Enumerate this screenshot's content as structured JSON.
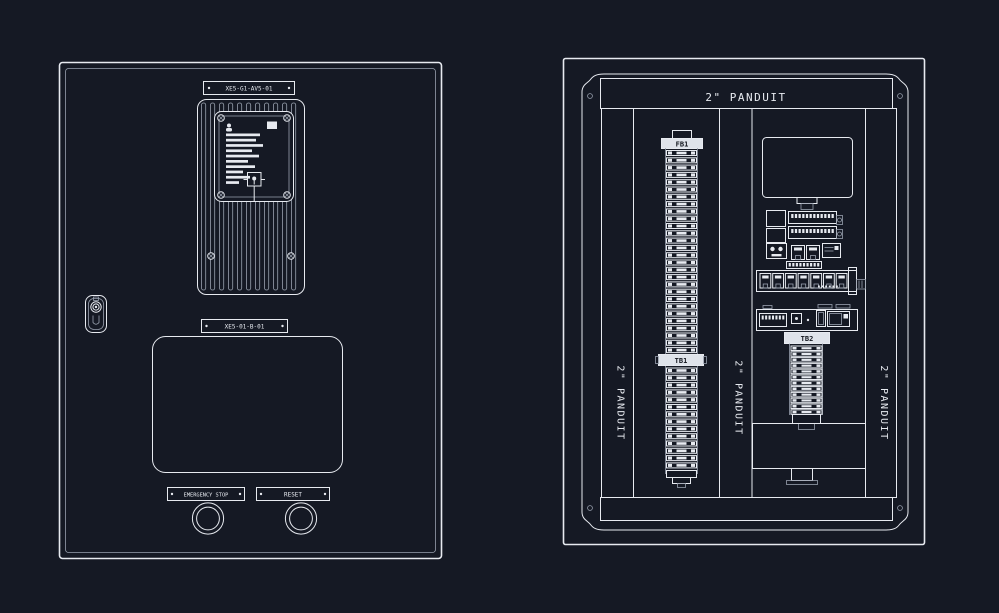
{
  "title": "electrical-enclosure-cad-drawing",
  "colors": {
    "background": "#151924",
    "line": "#e7eaf0",
    "dim_line": "#98a0ae"
  },
  "front_door": {
    "top_nameplate": "XE5-G1-AV5-01",
    "mid_nameplate": "XE5-01-B-01",
    "emergency_stop_label": "EMERGENCY STOP",
    "reset_label": "RESET"
  },
  "back_panel": {
    "top_duct_label": "2\" PANDUIT",
    "left_duct_label": "2\" PANDUIT",
    "middle_duct_label": "2\" PANDUIT",
    "right_duct_label": "2\" PANDUIT",
    "fuse_block_tag": "FB1",
    "terminal_strip_tag": "TB1",
    "terminal_strip2_tag": "TB2"
  }
}
